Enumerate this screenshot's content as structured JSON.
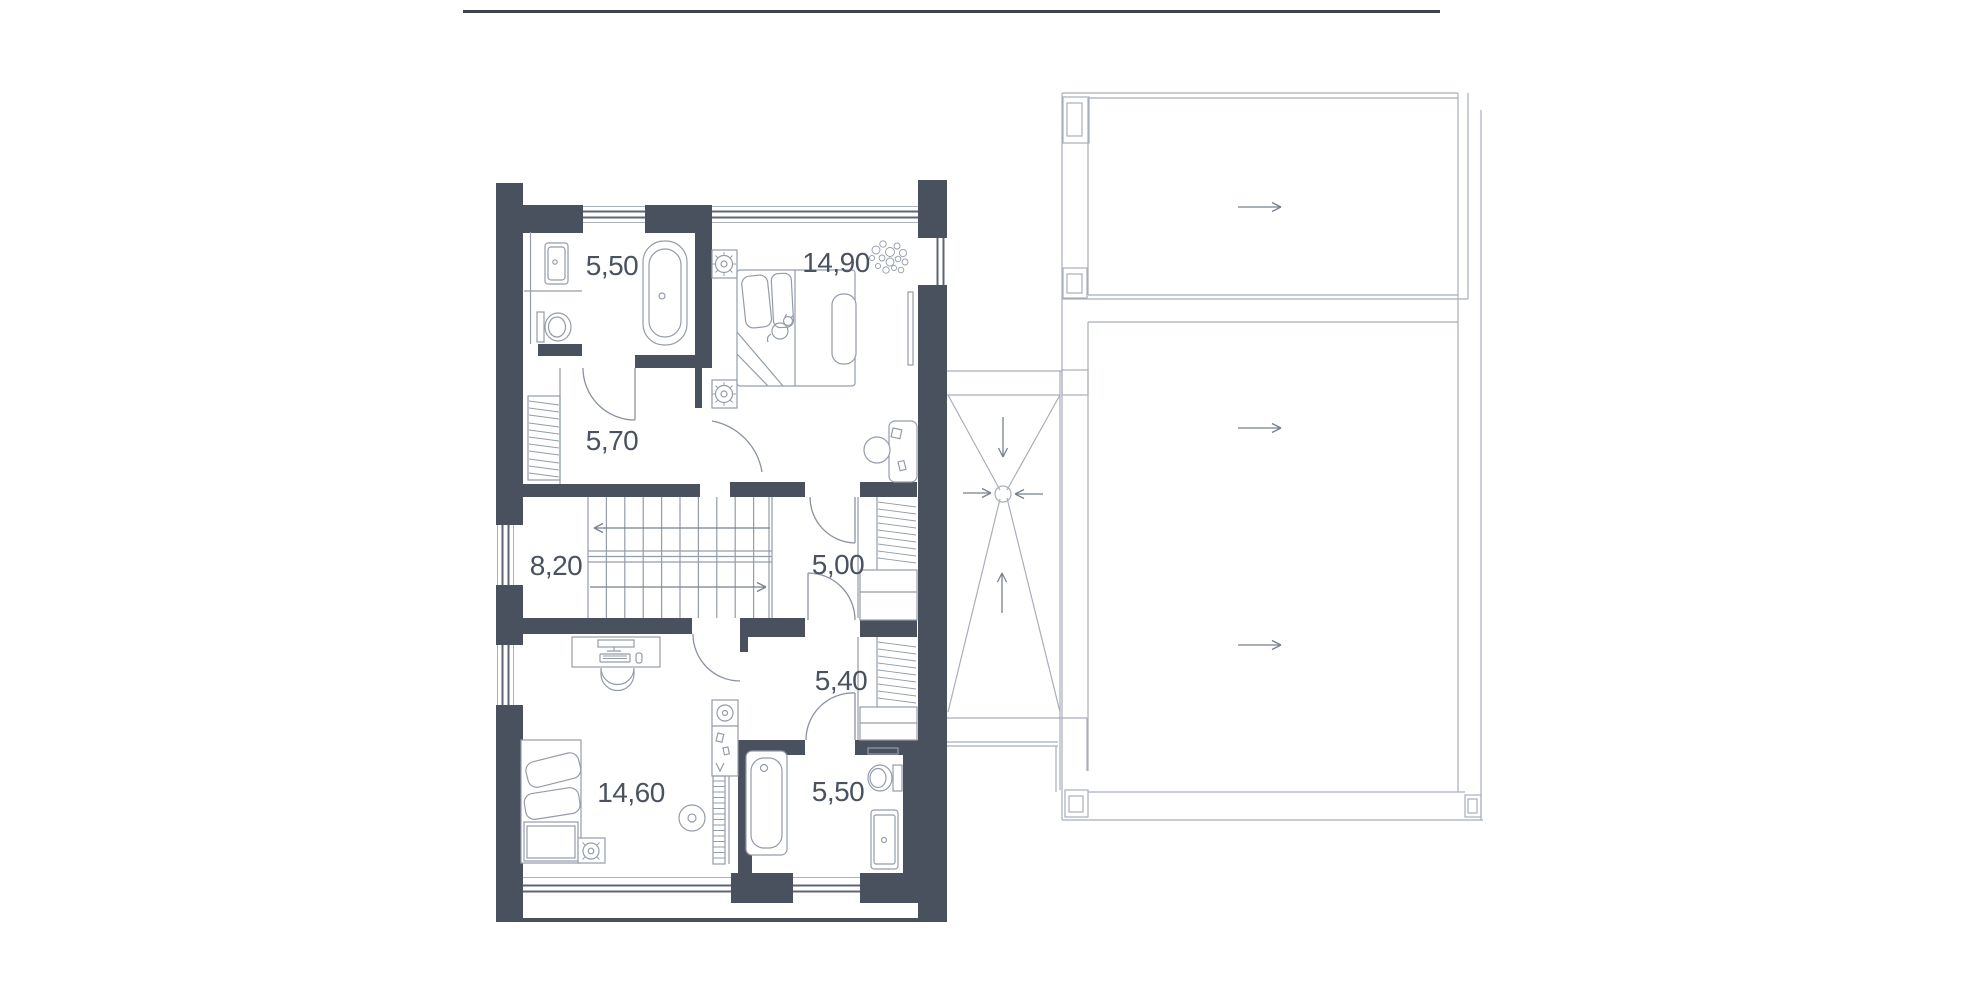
{
  "document": {
    "type": "floor-plan",
    "floor": "upper-level",
    "background": "#ffffff"
  },
  "header": {
    "divider_present": true,
    "divider_color": "#3d434d"
  },
  "plan": {
    "rooms": [
      {
        "id": "bathroom-top",
        "area_label": "5,50",
        "x": 612,
        "y": 266
      },
      {
        "id": "bedroom-top",
        "area_label": "14,90",
        "x": 836,
        "y": 263
      },
      {
        "id": "hall",
        "area_label": "5,70",
        "x": 612,
        "y": 441
      },
      {
        "id": "staircase",
        "area_label": "8,20",
        "x": 556,
        "y": 566
      },
      {
        "id": "corridor",
        "area_label": "5,00",
        "x": 838,
        "y": 565
      },
      {
        "id": "wardrobe",
        "area_label": "5,40",
        "x": 841,
        "y": 681
      },
      {
        "id": "bedroom-bottom",
        "area_label": "14,60",
        "x": 631,
        "y": 793
      },
      {
        "id": "bathroom-bottom",
        "area_label": "5,50",
        "x": 838,
        "y": 792
      }
    ]
  },
  "icons": {
    "stair_up_arrow": "direction-arrow",
    "roof_slope_arrows": "slope-direction-arrow",
    "roof_drain": "drain-circle-with-converging-arrows"
  },
  "colors": {
    "wall": "#49505e",
    "line": "#949caa",
    "lightline": "#aab0bc",
    "roof": "#a8aeba",
    "door": "#8a92a1",
    "window": "#5d6575",
    "arrow": "#78818f",
    "text": "#4a5260",
    "divider": "#3d434d"
  }
}
